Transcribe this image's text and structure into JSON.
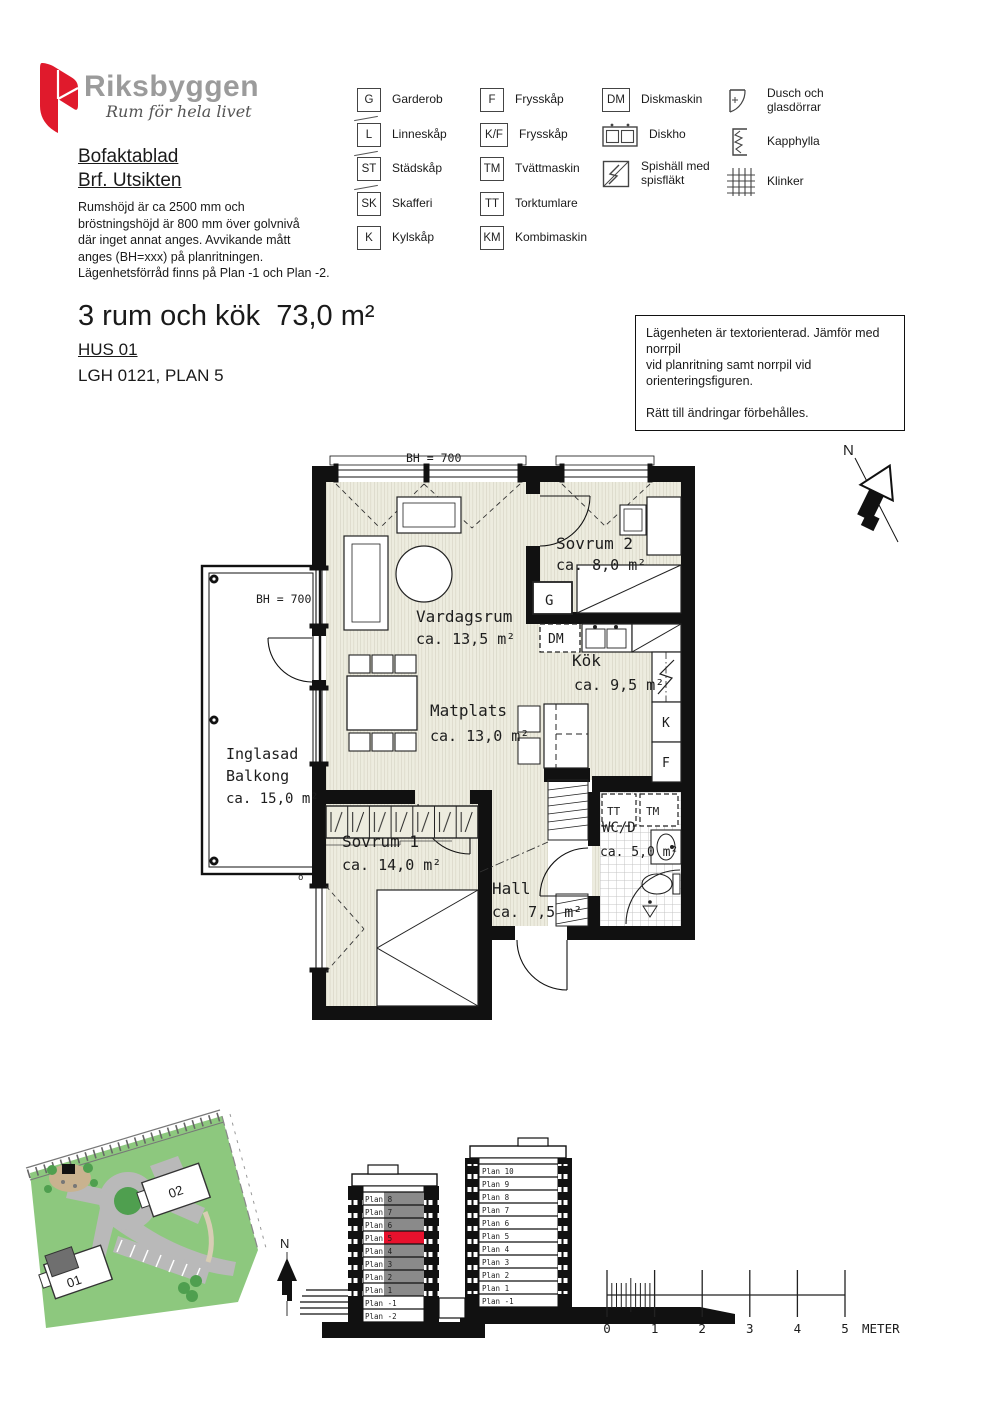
{
  "logo": {
    "brand": "Riksbyggen",
    "tagline": "Rum för hela livet"
  },
  "header": {
    "doc_title_line1": "Bofaktablad",
    "doc_title_line2": "Brf. Utsikten",
    "desc": [
      "Rumshöjd är ca 2500 mm och",
      "bröstningshöjd är 800 mm över golvnivå",
      "där inget annat anges. Avvikande mått",
      "anges (BH=xxx) på planritningen.",
      "Lägenhetsförråd finns på Plan -1 och Plan -2."
    ]
  },
  "legend": {
    "columns": [
      {
        "items": [
          {
            "symbol": "G",
            "label": "Garderob"
          },
          {
            "symbol": "L",
            "label": "Linneskåp"
          },
          {
            "symbol": "ST",
            "label": "Städskåp"
          },
          {
            "symbol": "SK",
            "label": "Skafferi"
          },
          {
            "symbol": "K",
            "label": "Kylskåp"
          }
        ]
      },
      {
        "items": [
          {
            "symbol": "F",
            "label": "Frysskåp"
          },
          {
            "symbol": "K/F",
            "label": "Frysskåp"
          },
          {
            "symbol": "TM",
            "label": "Tvättmaskin"
          },
          {
            "symbol": "TT",
            "label": "Torktumlare"
          },
          {
            "symbol": "KM",
            "label": "Kombimaskin"
          }
        ]
      },
      {
        "items": [
          {
            "symbol": "DM",
            "label": "Diskmaskin"
          },
          {
            "icon": "sink-icon",
            "label": "Diskho"
          },
          {
            "icon": "stove-icon",
            "label": "Spishäll med\nspisfläkt"
          }
        ]
      },
      {
        "items": [
          {
            "icon": "shower-icon",
            "label": "Dusch och\nglasdörrar"
          },
          {
            "icon": "coatrack-icon",
            "label": "Kapphylla"
          },
          {
            "icon": "tiles-icon",
            "label": "Klinker"
          }
        ]
      }
    ]
  },
  "title": {
    "main": "3 rum och kök  73,0 m²",
    "hus": "HUS 01",
    "lgh": "LGH 0121, PLAN 5"
  },
  "notice": {
    "line1": "Lägenheten är textorienterad. Jämför med norrpil",
    "line2": "vid planritning samt norrpil vid orienteringsfiguren.",
    "line3": "Rätt till ändringar förbehålles."
  },
  "floorplan": {
    "bh_top": "BH = 700",
    "bh_balcony": "BH = 700",
    "north": "N",
    "vent_mark": "ö",
    "rooms": {
      "vardagsrum": {
        "name": "Vardagsrum",
        "area": "ca. 13,5 m²"
      },
      "sovrum2": {
        "name": "Sovrum 2",
        "area": "ca. 8,0 m²"
      },
      "kok": {
        "name": "Kök",
        "area": "ca. 9,5 m²"
      },
      "matplats": {
        "name": "Matplats",
        "area": "ca. 13,0 m²"
      },
      "sovrum1": {
        "name": "Sovrum 1",
        "area": "ca. 14,0 m²"
      },
      "hall": {
        "name": "Hall",
        "area": "ca. 7,5 m²"
      },
      "wcd": {
        "name": "WC/D",
        "area": "ca. 5,0 m²"
      },
      "balkong": {
        "line1": "Inglasad",
        "line2": "Balkong",
        "area": "ca. 15,0 m²"
      }
    },
    "fixtures": {
      "g": "G",
      "dm": "DM",
      "k": "K",
      "f": "F",
      "tt": "TT",
      "tm": "TM"
    }
  },
  "siteplan": {
    "building01": "01",
    "building02": "02",
    "north": "N"
  },
  "elevations": {
    "hus01": {
      "floors": [
        "Plan 8",
        "Plan 7",
        "Plan 6",
        "Plan 5",
        "Plan 4",
        "Plan 3",
        "Plan 2",
        "Plan 1",
        "Plan -1",
        "Plan -2"
      ],
      "highlight_floor": "Plan 5",
      "highlight_color": "#e8112d"
    },
    "hus02": {
      "floors": [
        "Plan 10",
        "Plan 9",
        "Plan 8",
        "Plan 7",
        "Plan 6",
        "Plan 5",
        "Plan 4",
        "Plan 3",
        "Plan 2",
        "Plan 1",
        "Plan -1"
      ]
    }
  },
  "scalebar": {
    "ticks": [
      "0",
      "1",
      "2",
      "3",
      "4",
      "5"
    ],
    "unit": "METER"
  },
  "colors": {
    "logo_red": "#e01a2c",
    "brand_gray": "#9b9b9b",
    "highlight_red": "#e8112d",
    "site_green": "#8dc87e",
    "road_gray": "#b9b9b9",
    "dark_green": "#4f9f4f"
  }
}
